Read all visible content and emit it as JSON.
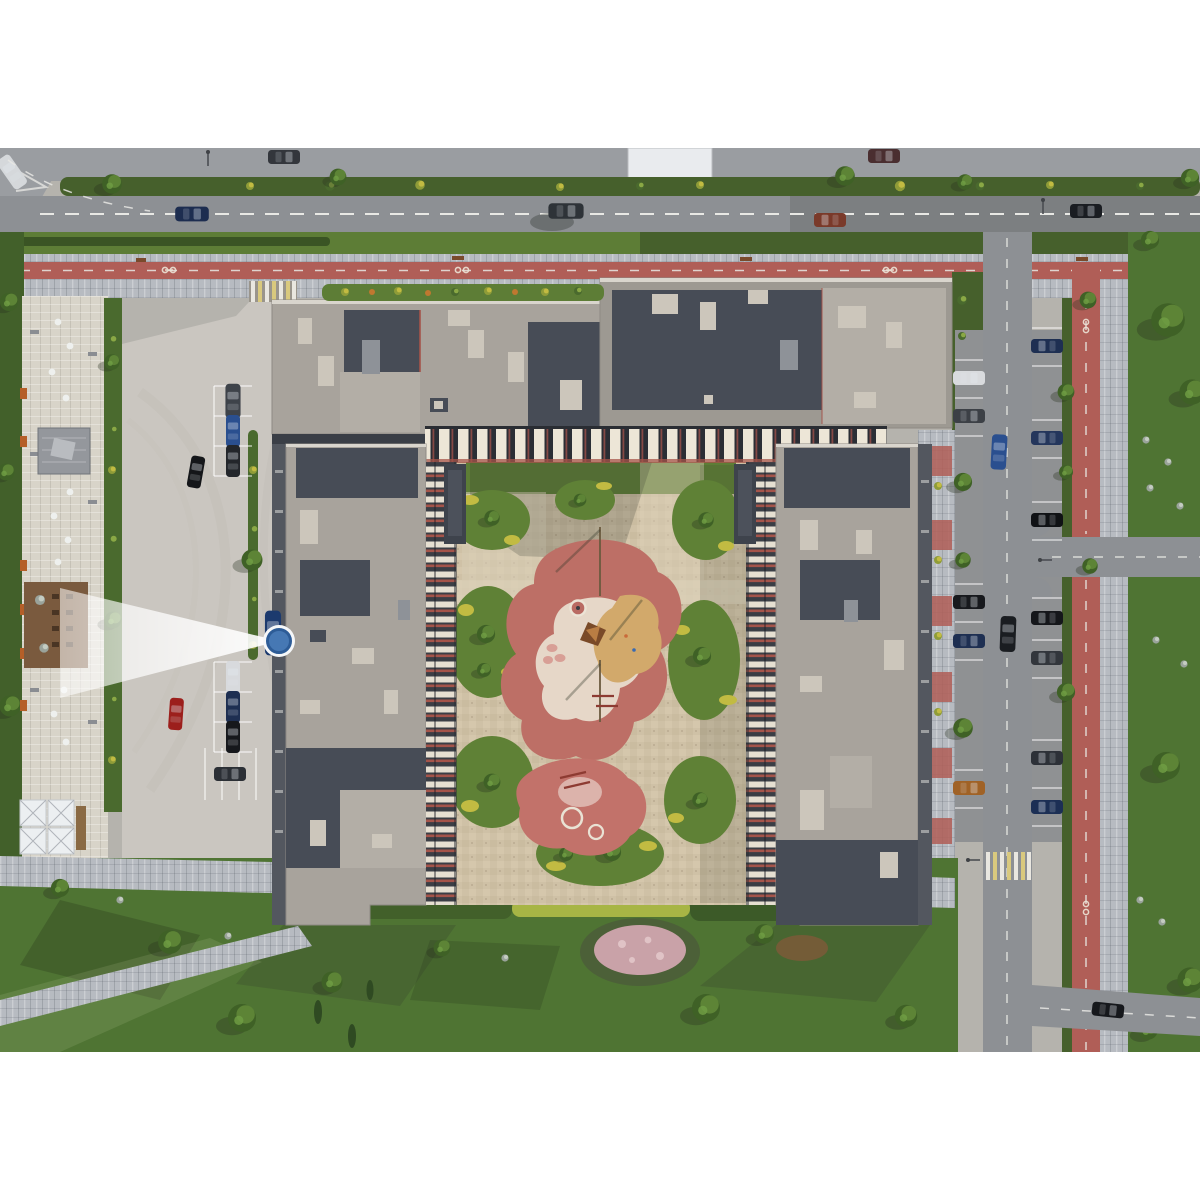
{
  "scene": {
    "type": "aerial-3d-architectural-render",
    "description": "Top-down bird's-eye 3D render of a residential complex: U-shaped apartment buildings with grey roofs around a landscaped courtyard with a pink playground, flanked by streets with red bike lanes, parking lots, a cafe plaza and lawns. A blue camera-viewpoint marker with a white view cone sits on the west access road.",
    "camera_marker": {
      "x": 279,
      "y": 641,
      "transform": "translate(279 641)",
      "facing": "west",
      "style": "blue dot, white ring, translucent white view cone"
    }
  },
  "palette": {
    "bg": "#ffffff",
    "road": "#8d9094",
    "roadTop": "#9a9da1",
    "lot": "#cac6c0",
    "paver": "#b7bbc1",
    "paverLight": "#d8d4c9",
    "redLane": "#b05e57",
    "zebraYellow": "#d9c97e",
    "grass": "#5d7d36",
    "grassDark": "#46602c",
    "lawn": "#4f7433",
    "hedge": "#42602a",
    "hedgeYellow": "#a7b545",
    "court": "#cfc1a6",
    "courtLight": "#dbd0b8",
    "island": "#5f8136",
    "accentYellow": "#c2bb42",
    "pink": "#bd6f66",
    "pinkLight": "#dcb3ab",
    "pathWhite": "#e9dfd0",
    "sand": "#d2a96b",
    "roof": "#a8a39c",
    "roofDark": "#474c56",
    "roofLight": "#b3aea6",
    "box": "#ccc6bb",
    "parapet": "#d9d5cd",
    "facadeDark": "#2b2e35",
    "stripe": "#ede6d7",
    "redAccent": "#a5544a",
    "facadeSide": "#53575f",
    "dash": "#e8e8e4",
    "markerBlue": "#4678b4",
    "markerRing": "#f5f7f9",
    "markerEdge": "#2d5c97",
    "shadow": "rgba(50,56,44,0.22)",
    "cone": "rgba(255,255,255,0.85)"
  }
}
